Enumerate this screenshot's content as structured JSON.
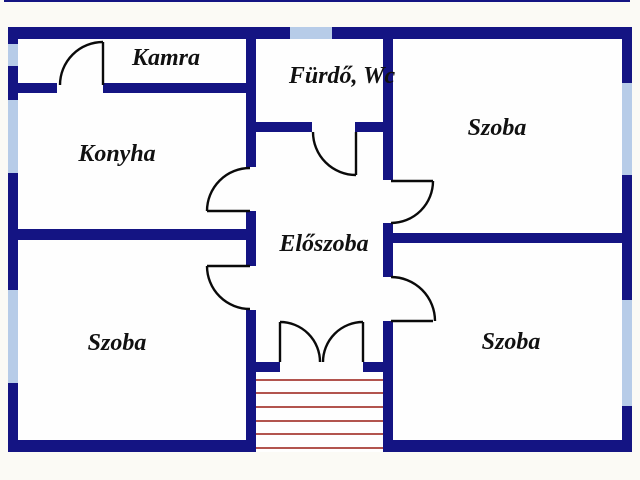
{
  "floor_plan": {
    "rooms": [
      {
        "name": "kamra",
        "label": "Kamra"
      },
      {
        "name": "furdo-wc",
        "label": "Fürdő, Wc"
      },
      {
        "name": "konyha",
        "label": "Konyha"
      },
      {
        "name": "szoba-top-right",
        "label": "Szoba"
      },
      {
        "name": "eloszoba",
        "label": "Előszoba"
      },
      {
        "name": "szoba-bottom-left",
        "label": "Szoba"
      },
      {
        "name": "szoba-bottom-right",
        "label": "Szoba"
      }
    ],
    "stairs": {
      "steps": 6
    },
    "windows": {
      "count": 6
    },
    "doors": {
      "count": 8
    },
    "colors": {
      "wall": "#141483",
      "window": "#b7cce8",
      "stairs": "#b2544e",
      "door": "#0a0a0a",
      "label": "#111111",
      "interior": "#fefefe",
      "margin": "#fbfaf5"
    }
  }
}
